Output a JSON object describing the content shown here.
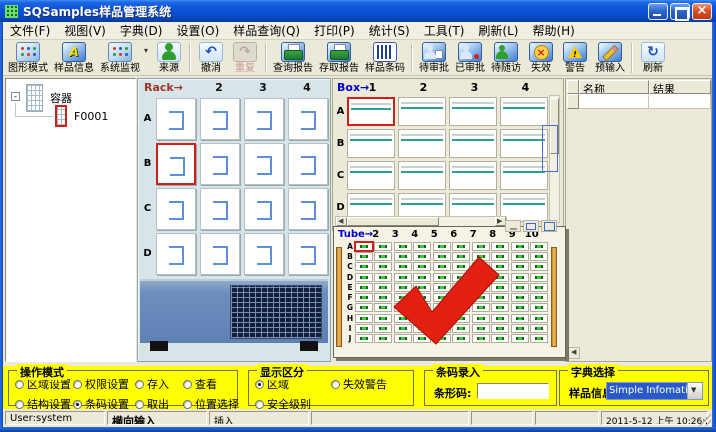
{
  "colors": {
    "selection_red": "#cc2018",
    "panel_yellow": "#ffff00",
    "combo_highlight": "#2a5ac8",
    "title_blue": "#0b52d8"
  },
  "window": {
    "title": "SQSamples样品管理系统"
  },
  "menu": [
    "文件(F)",
    "视图(V)",
    "字典(D)",
    "设置(O)",
    "样品查询(Q)",
    "打印(P)",
    "统计(S)",
    "工具(T)",
    "刷新(L)",
    "帮助(H)"
  ],
  "toolbar": [
    {
      "label": "图形模式",
      "icon": "grid-mode"
    },
    {
      "label": "样品信息",
      "icon": "sample-info"
    },
    {
      "label": "系统监视",
      "icon": "system-monitor",
      "dropdown": true
    },
    {
      "label": "来源",
      "icon": "person-source"
    },
    {
      "sep": true
    },
    {
      "label": "撤消",
      "icon": "undo-arrow"
    },
    {
      "label": "重复",
      "icon": "redo",
      "disabled": true
    },
    {
      "sep": true
    },
    {
      "label": "查询报告",
      "icon": "printer-query"
    },
    {
      "label": "存取报告",
      "icon": "printer-save"
    },
    {
      "label": "样品条码",
      "icon": "barcode"
    },
    {
      "sep": true
    },
    {
      "label": "待审批",
      "icon": "doc-pending"
    },
    {
      "label": "已审批",
      "icon": "doc-approved"
    },
    {
      "label": "待随访",
      "icon": "doc-followup"
    },
    {
      "label": "失效",
      "icon": "invalid-cross"
    },
    {
      "label": "警告",
      "icon": "warning-triangle"
    },
    {
      "label": "预输入",
      "icon": "pencil-input"
    },
    {
      "sep": true
    },
    {
      "label": "刷新",
      "icon": "refresh-circle"
    }
  ],
  "tree": {
    "root_label": "容器",
    "child_label": "F0001"
  },
  "rack": {
    "title": "Rack→",
    "col_headers": [
      "2",
      "3",
      "4"
    ],
    "rows": [
      "A",
      "B",
      "C",
      "D"
    ],
    "cols": 4,
    "selected_row": "B",
    "selected_col": 1
  },
  "box": {
    "title": "Box→",
    "col_headers": [
      "1",
      "2",
      "3",
      "4"
    ],
    "rows": [
      "A",
      "B",
      "C",
      "D"
    ],
    "cols": 4,
    "selected_row": "A",
    "selected_col": 1
  },
  "tube": {
    "title": "Tube→",
    "col_headers": [
      "2",
      "3",
      "4",
      "5",
      "6",
      "7",
      "8",
      "9",
      "10"
    ],
    "rows": [
      "A",
      "B",
      "C",
      "D",
      "E",
      "F",
      "G",
      "H",
      "I",
      "J"
    ],
    "cols": 10,
    "selected_row": "A",
    "selected_col": 1
  },
  "results_table": {
    "headers": [
      "名称",
      "结果"
    ]
  },
  "operation_mode": {
    "title": "操作模式",
    "options": [
      {
        "label": "区域设置",
        "checked": false
      },
      {
        "label": "权限设置",
        "checked": false
      },
      {
        "label": "存入",
        "checked": false
      },
      {
        "label": "查看",
        "checked": false
      },
      {
        "label": "结构设置",
        "checked": false
      },
      {
        "label": "条码设置",
        "checked": true
      },
      {
        "label": "取出",
        "checked": false
      },
      {
        "label": "位置选择",
        "checked": false
      }
    ]
  },
  "display_mode": {
    "title": "显示区分",
    "options": [
      {
        "label": "区域",
        "checked": true
      },
      {
        "label": "失效警告",
        "checked": false
      },
      {
        "label": "安全级别",
        "checked": false
      }
    ]
  },
  "barcode_entry": {
    "title": "条码录入",
    "label": "条形码:",
    "value": ""
  },
  "dictionary": {
    "title": "字典选择",
    "label": "样品信息",
    "value": "Simple Infomation"
  },
  "statusbar": {
    "user": "User:system",
    "mode": "横向输入",
    "insert": "插入",
    "datetime": "2011-5-12 上午 10:26:26"
  }
}
